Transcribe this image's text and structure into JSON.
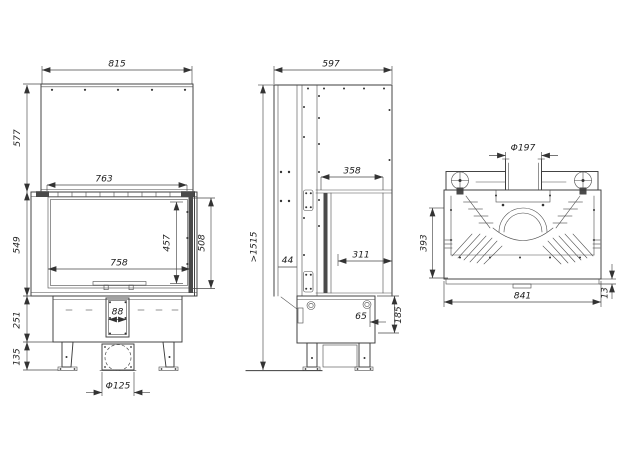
{
  "views": {
    "front": {
      "label": "front-view",
      "dims": {
        "hood_width": "815",
        "hood_height": "577",
        "hood_inner_width": "763",
        "firebox_height": "549",
        "glass_height": "457",
        "door_height": "508",
        "glass_width": "758",
        "channel_width": "88",
        "base_height": "251",
        "leg_height": "135",
        "inlet_diameter": "Φ125"
      }
    },
    "side": {
      "label": "side-view",
      "dims": {
        "depth": "597",
        "min_height": ">1515",
        "glass_depth": "358",
        "frame_gap": "44",
        "glass_inner_depth": "311",
        "outlet_offset": "65",
        "base_depth": "185"
      }
    },
    "top": {
      "label": "top-view",
      "dims": {
        "flue_diameter": "Φ197",
        "body_depth": "393",
        "body_width": "841",
        "lip_height": "13"
      }
    }
  },
  "colors": {
    "line": "#3c3c3c",
    "background": "#ffffff"
  }
}
